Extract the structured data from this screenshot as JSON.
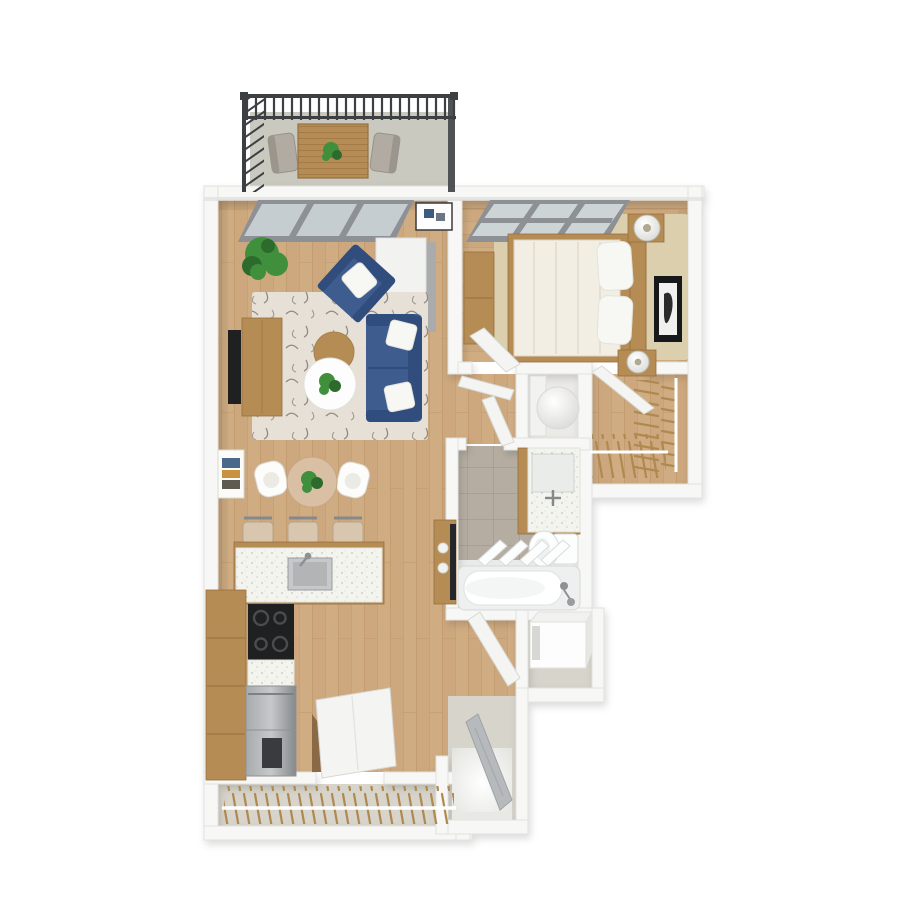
{
  "meta": {
    "title": "3D rendered one-bedroom apartment floor plan, top-down view",
    "canvas": {
      "width": 900,
      "height": 900,
      "background": "#ffffff"
    },
    "style": "photoreal 3D dollhouse floor plan, no text labels"
  },
  "colors": {
    "wall": "#f7f7f5",
    "wall-edge": "#e2e2df",
    "wall-shade": "#d8d8d5",
    "floor-wood": "#cda87e",
    "floor-wood-dark": "#b98f60",
    "floor-wood-light": "#dcba90",
    "balcony-floor": "#c9c9bf",
    "railing": "#3d4043",
    "glass": "#ccd4d6",
    "glass-frame": "#8d9094",
    "rug": "#e6e0d6",
    "rug-pattern": "#6f675d",
    "bedroom-rug": "#dccfae",
    "sofa": "#3e5c8e",
    "sofa-dark": "#304d7d",
    "pillow": "#f7f7f4",
    "wood": "#b68c55",
    "wood-dark": "#97703f",
    "counter": "#f4f4ee",
    "steel": "#a8abad",
    "steel-dark": "#86898b",
    "tv-black": "#1e2022",
    "tile": "#b5ada1",
    "grout": "#a49b8f",
    "fixture": "#fcfdfd",
    "door-leaf": "#f4f4f2",
    "entry-door": "#b7babc",
    "greige": "#d7d4cb",
    "plant": "#3f8f3d",
    "plant-dark": "#2d6b2c",
    "hanger": "#b08950",
    "lamp": "#c9c9c4",
    "art-frame": "#17181a",
    "stool": "#d9c6ae",
    "chair-taupe": "#b1aba1",
    "bedding": "#f2eee4",
    "bedding-edge": "#ddd4c2"
  },
  "scene": {
    "type": "3d-floor-plan",
    "rooms": [
      {
        "name": "balcony",
        "floor": "concrete",
        "furniture": [
          "metal-railing",
          "slatted-outdoor-table",
          "table-plant",
          "patio-chair-left",
          "patio-chair-right"
        ]
      },
      {
        "name": "living-room",
        "floor": "hardwood",
        "furniture": [
          "sliding-glass-door",
          "potted-plant",
          "wall-art-blue",
          "white-cabinet",
          "blue-armchair",
          "blue-sofa",
          "patterned-area-rug",
          "tv-console",
          "tv",
          "round-wood-coffee-table",
          "round-white-side-table",
          "table-plant"
        ]
      },
      {
        "name": "dining-area",
        "floor": "hardwood",
        "furniture": [
          "round-dining-table",
          "dining-chair-left",
          "dining-chair-right",
          "centerpiece-plant",
          "wall-art-colorful"
        ]
      },
      {
        "name": "kitchen",
        "floor": "hardwood",
        "furniture": [
          "island-with-sink",
          "bar-stool",
          "bar-stool",
          "bar-stool",
          "tall-pantry-cabinet",
          "black-cooktop",
          "stainless-appliance-stack",
          "side-cabinet-with-bowls"
        ]
      },
      {
        "name": "bedroom",
        "floor": "hardwood",
        "furniture": [
          "grid-window",
          "dresser",
          "bed-with-oak-headboard",
          "pillows",
          "nightstand-lamp-top",
          "nightstand-lamp-bottom",
          "wall-art-portrait",
          "beige-area-rug",
          "open-door"
        ]
      },
      {
        "name": "walk-in-closet",
        "floor": "hardwood",
        "furniture": [
          "clothes-rod-right-with-hangers",
          "clothes-rod-bottom-with-hangers",
          "open-door"
        ]
      },
      {
        "name": "hallway",
        "floor": "hardwood",
        "furniture": [
          "open-door",
          "open-door"
        ]
      },
      {
        "name": "utility-closet",
        "floor": "vinyl",
        "furniture": [
          "water-heater-cylinder",
          "white-shelf"
        ]
      },
      {
        "name": "bathroom",
        "floor": "tile",
        "furniture": [
          "vanity-with-speckled-counter",
          "sink-faucet",
          "toilet",
          "bathtub",
          "shower-glass-panels"
        ]
      },
      {
        "name": "laundry-closet",
        "floor": "vinyl",
        "furniture": [
          "washer"
        ]
      },
      {
        "name": "entry",
        "floor": "vinyl",
        "furniture": [
          "open-front-door-gray",
          "bright-threshold"
        ]
      },
      {
        "name": "coat-closet",
        "floor": "vinyl",
        "furniture": [
          "clothes-rod-with-hangers",
          "open-door"
        ]
      }
    ]
  }
}
